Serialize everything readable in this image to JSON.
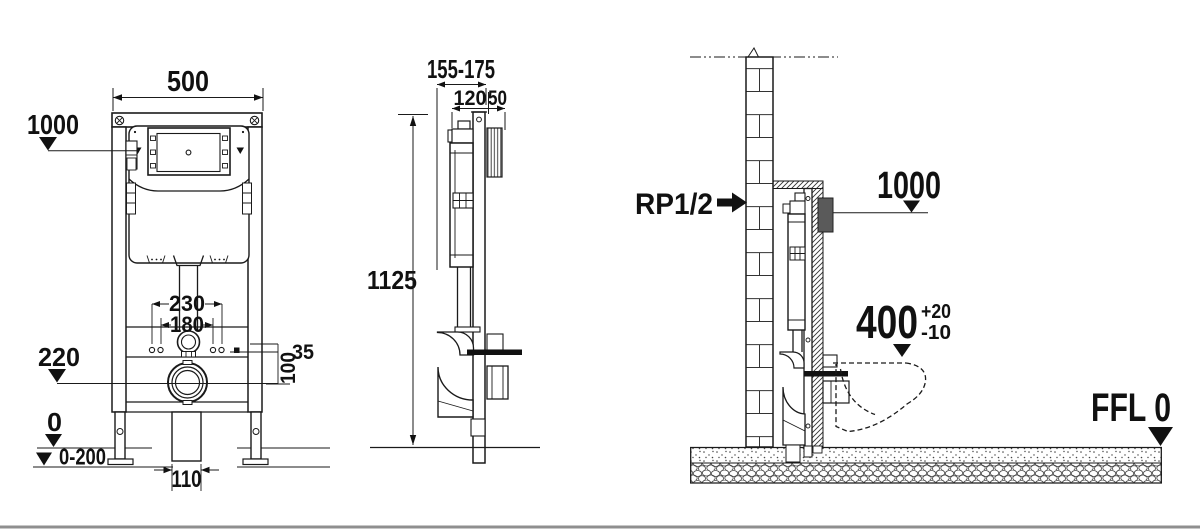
{
  "front": {
    "frame_width": "500",
    "actuation_height": "1000",
    "fixing_span_outer": "230",
    "fixing_span_inner": "180",
    "outlet_height": "220",
    "offset_35": "35",
    "offset_100": "100",
    "floor_zero": "0",
    "adjust_range": "0-200",
    "drain_width": "110"
  },
  "side": {
    "depth_range": "155-175",
    "cistern_depth": "120",
    "plate_depth": "50",
    "frame_height": "1125"
  },
  "install": {
    "water_connection": "RP1/2",
    "panel_height": "1000",
    "pan_height": "400",
    "tolerance_plus": "+20",
    "tolerance_minus": "-10",
    "finished_floor": "FFL 0"
  },
  "colors": {
    "ink": "#1a1a1a",
    "flush_plate_fill": "#5a5a5a",
    "bottom_rule": "#8f8f8f"
  }
}
